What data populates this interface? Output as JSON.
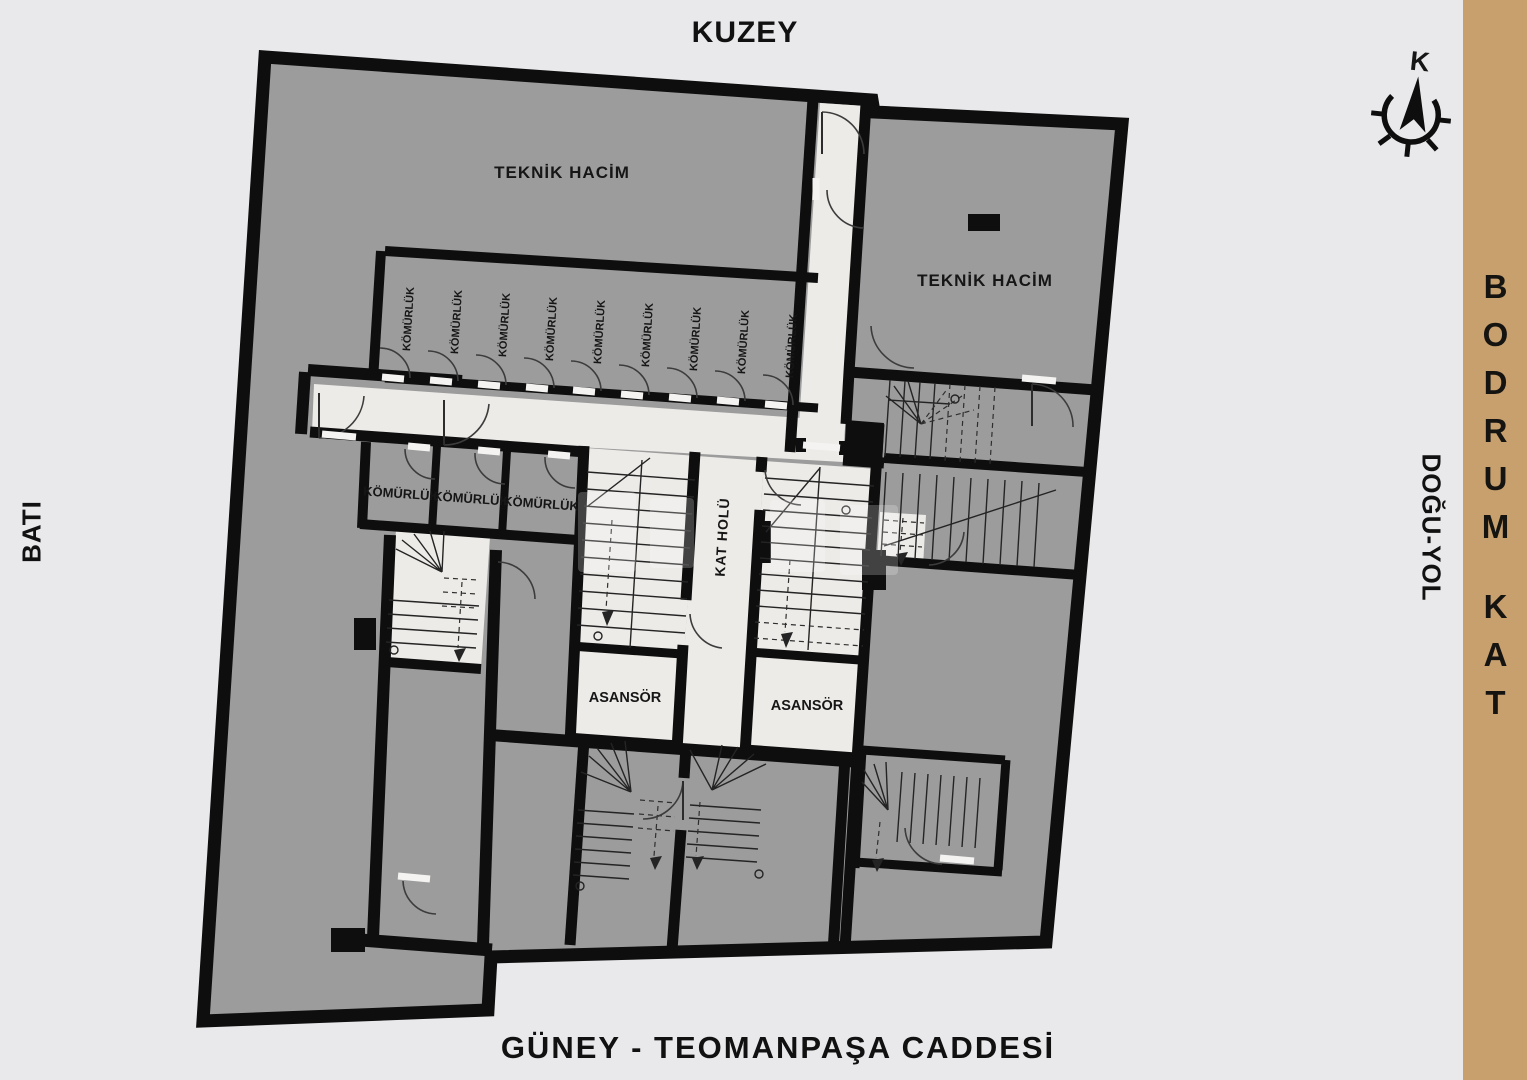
{
  "page": {
    "background_color": "#e9e8eb"
  },
  "compass": {
    "north_letter": "K"
  },
  "orientation_labels": {
    "north": "KUZEY",
    "west": "BATI",
    "east": "DOĞU-YOL",
    "south": "GÜNEY - TEOMANPAŞA CADDESİ"
  },
  "floor_panel": {
    "word1": "BODRUM",
    "word2": "KAT",
    "color": "#c7a06e"
  },
  "plan": {
    "rooms": {
      "teknik_hacim_left": "TEKNİK HACİM",
      "teknik_hacim_right": "TEKNİK HACİM",
      "komurluk": "KÖMÜRLÜK",
      "kat_holu": "KAT HOLÜ",
      "asansor": "ASANSÖR",
      "komurluk_top_row_count": 9,
      "komurluk_lower_row_count": 3
    },
    "colors": {
      "wall": "#0e0e0e",
      "room_fill": "#9c9c9c",
      "floor_light": "#edebe8"
    }
  }
}
